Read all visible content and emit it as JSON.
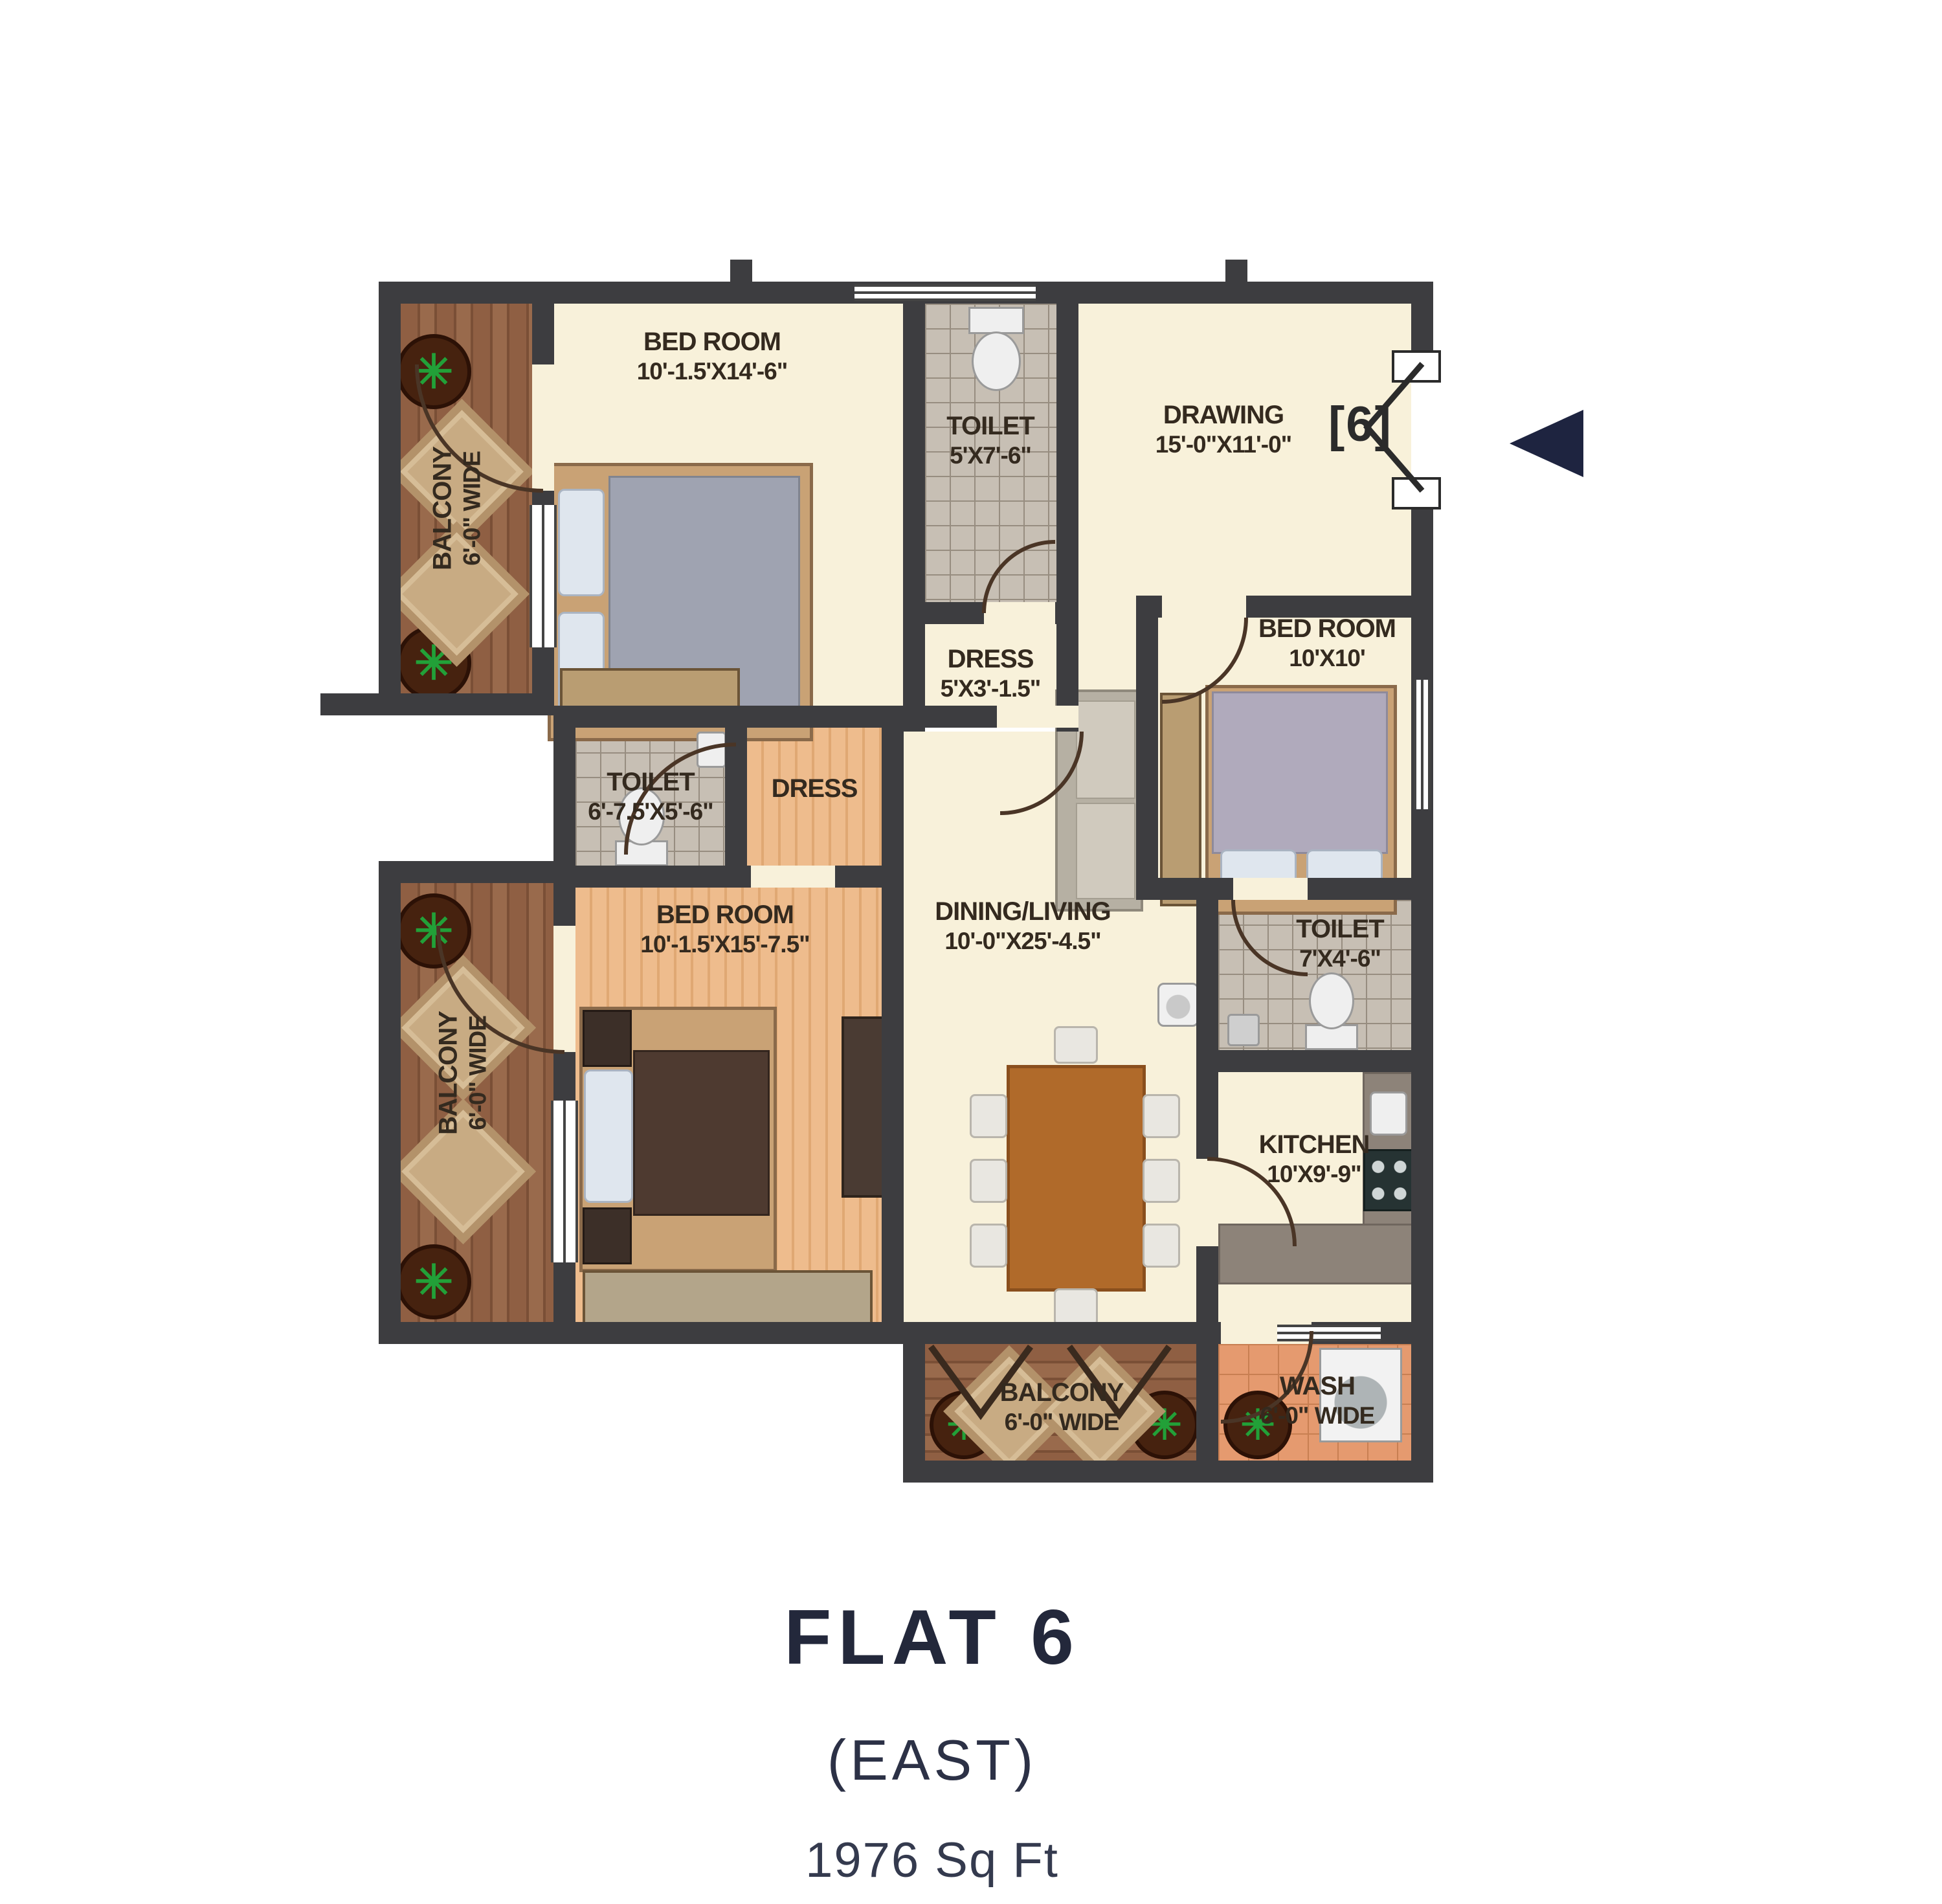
{
  "title": {
    "name": "FLAT 6",
    "facing": "(EAST)",
    "area": "1976 Sq Ft"
  },
  "plan": {
    "unit_marker": "[6]",
    "entrance_arrow_icon": "entrance-direction-arrow-left",
    "colors": {
      "wall": "#3d3d40",
      "floor_cream": "#f8f1da",
      "wood_dark": "#8f5f43",
      "wood_light": "#eebc8d",
      "tile_gray": "#c7bfb4",
      "tile_wash": "#e59a6f",
      "accent_navy": "#1e2440",
      "door_arc": "#4a3526",
      "label_text": "#342a1f"
    },
    "rooms": {
      "bedroom_top": {
        "label": "BED ROOM",
        "dims": "10'-1.5'X14'-6\""
      },
      "toilet_top": {
        "label": "TOILET",
        "dims": "5'X7'-6\""
      },
      "dress_top": {
        "label": "DRESS",
        "dims": "5'X3'-1.5\""
      },
      "drawing": {
        "label": "DRAWING",
        "dims": "15'-0\"X11'-0\""
      },
      "bedroom_right": {
        "label": "BED ROOM",
        "dims": "10'X10'"
      },
      "toilet_mid": {
        "label": "TOILET",
        "dims": "6'-7.5'X5'-6\""
      },
      "dress_mid": {
        "label": "DRESS"
      },
      "bedroom_left": {
        "label": "BED ROOM",
        "dims": "10'-1.5'X15'-7.5\""
      },
      "dining_living": {
        "label": "DINING/LIVING",
        "dims": "10'-0\"X25'-4.5\""
      },
      "toilet_right": {
        "label": "TOILET",
        "dims": "7'X4'-6\""
      },
      "kitchen": {
        "label": "KITCHEN",
        "dims": "10'X9'-9\""
      },
      "balcony_top": {
        "label": "BALCONY",
        "dims": "6'-0\" WIDE"
      },
      "balcony_left": {
        "label": "BALCONY",
        "dims": "6'-0\" WIDE"
      },
      "balcony_bottom": {
        "label": "BALCONY",
        "dims": "6'-0\" WIDE"
      },
      "wash": {
        "label": "WASH",
        "dims": "6'-0\" WIDE"
      }
    }
  }
}
